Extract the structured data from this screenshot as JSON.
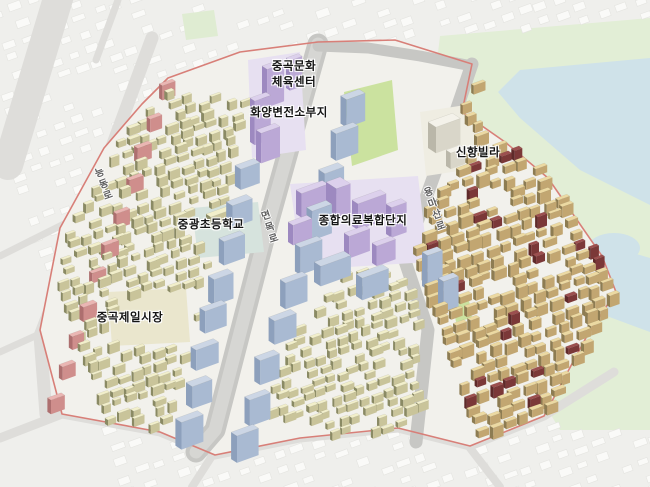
{
  "map": {
    "canvas": {
      "width": 650,
      "height": 487
    },
    "labels": [
      {
        "id": "culture-sports-center",
        "text": "중곡문화\n체육센터",
        "x": 294,
        "y": 74,
        "kind": "place"
      },
      {
        "id": "substation-site",
        "text": "화양변전소부지",
        "x": 289,
        "y": 113,
        "kind": "place"
      },
      {
        "id": "elementary-school",
        "text": "중광초등학교",
        "x": 211,
        "y": 225,
        "kind": "place"
      },
      {
        "id": "medical-complex",
        "text": "종합의료복합단지",
        "x": 363,
        "y": 221,
        "kind": "place"
      },
      {
        "id": "jeil-market",
        "text": "중곡제일시장",
        "x": 130,
        "y": 318,
        "kind": "place"
      },
      {
        "id": "shinhyang-villa",
        "text": "신향빌라",
        "x": 478,
        "y": 153,
        "kind": "place"
      },
      {
        "id": "road-neungdong-ro",
        "text": "능동로",
        "x": 102,
        "y": 185,
        "kind": "road",
        "rotate": -20
      },
      {
        "id": "road-myeonmok-ro",
        "text": "면목로",
        "x": 268,
        "y": 228,
        "kind": "road",
        "rotate": -18
      },
      {
        "id": "road-yongmasan-ro",
        "text": "용마산로",
        "x": 433,
        "y": 210,
        "kind": "road",
        "rotate": -20
      }
    ],
    "colors": {
      "bg": "#efefec",
      "context_building": "#fafaf8",
      "context_building_edge": "#e4e4e0",
      "context_road": "#deddda",
      "site_ground": "#f2f1ec",
      "road": "#c7c7c4",
      "road_inner": "#d6d6d3",
      "boundary": "#d87f78",
      "water": "#cfe2e9",
      "green_base": "#e2eed6",
      "park": "#cbe29f",
      "park_faint": "#dfecd2",
      "field": "#d6e3dd",
      "plaza": "#eae6cd",
      "plinth": "#e7e0f1",
      "plinth_ivory": "#efede2",
      "palettes": {
        "cream": [
          "#f2efcb",
          "#c9c49a",
          "#8a8a64"
        ],
        "tan": [
          "#ecd9a2",
          "#c4a store",
          "#8d7c52"
        ],
        "tan_fix": [
          "#ecd9a2",
          "#c2a671",
          "#8d7c52"
        ],
        "maroon": [
          "#9c4f4f",
          "#7b3838",
          "#5f2a2a"
        ],
        "pink": [
          "#eab6b3",
          "#cf8e8c",
          "#ad6f6f"
        ],
        "blue": [
          "#ccd6e5",
          "#a9bad2",
          "#8da0bc"
        ],
        "purple": [
          "#dcd0ec",
          "#bba8d6",
          "#9d89c0"
        ],
        "ivory": [
          "#f4f2ea",
          "#d9d6c9",
          "#bab7a9"
        ]
      }
    },
    "boundary": [
      [
        168,
        78
      ],
      [
        240,
        52
      ],
      [
        318,
        42
      ],
      [
        395,
        40
      ],
      [
        472,
        64
      ],
      [
        462,
        112
      ],
      [
        505,
        142
      ],
      [
        548,
        178
      ],
      [
        602,
        256
      ],
      [
        616,
        292
      ],
      [
        588,
        334
      ],
      [
        544,
        416
      ],
      [
        470,
        446
      ],
      [
        398,
        428
      ],
      [
        300,
        438
      ],
      [
        215,
        455
      ],
      [
        160,
        432
      ],
      [
        62,
        414
      ],
      [
        40,
        330
      ],
      [
        60,
        228
      ],
      [
        104,
        148
      ],
      [
        142,
        104
      ]
    ],
    "areas": [
      {
        "name": "hillside-green",
        "fill": "green_base",
        "pts": [
          [
            440,
            36
          ],
          [
            650,
            18
          ],
          [
            650,
            430
          ],
          [
            560,
            430
          ],
          [
            500,
            330
          ],
          [
            430,
            120
          ]
        ]
      },
      {
        "name": "stream-north",
        "fill": "water",
        "pts": [
          [
            498,
            92
          ],
          [
            520,
            70
          ],
          [
            650,
            58
          ],
          [
            650,
            205
          ],
          [
            580,
            170
          ],
          [
            520,
            118
          ]
        ]
      },
      {
        "name": "stream-east",
        "fill": "water",
        "pts": [
          [
            572,
            235
          ],
          [
            650,
            258
          ],
          [
            650,
            332
          ],
          [
            596,
            312
          ],
          [
            572,
            268
          ]
        ]
      },
      {
        "name": "pond",
        "fill": "water",
        "ellipse": [
          614,
          248,
          26,
          15
        ]
      }
    ],
    "context_roads": [
      {
        "pts": [
          [
            60,
            -8
          ],
          [
            8,
            165
          ]
        ],
        "w": 30
      },
      {
        "pts": [
          [
            152,
            38
          ],
          [
            96,
            190
          ],
          [
            40,
            336
          ],
          [
            46,
            414
          ]
        ],
        "w": 13
      },
      {
        "pts": [
          [
            0,
            438
          ],
          [
            62,
            414
          ],
          [
            160,
            432
          ],
          [
            215,
            455
          ],
          [
            300,
            438
          ],
          [
            398,
            428
          ],
          [
            470,
            446
          ],
          [
            544,
            416
          ],
          [
            614,
            372
          ]
        ],
        "w": 9
      },
      {
        "pts": [
          [
            212,
            456
          ],
          [
            192,
            487
          ]
        ],
        "w": 8
      },
      {
        "pts": [
          [
            0,
            256
          ],
          [
            96,
            208
          ]
        ],
        "w": 7
      },
      {
        "pts": [
          [
            0,
            352
          ],
          [
            44,
            332
          ]
        ],
        "w": 7
      },
      {
        "pts": [
          [
            118,
            0
          ],
          [
            96,
            60
          ]
        ],
        "w": 7
      },
      {
        "pts": [
          [
            470,
            448
          ],
          [
            500,
            487
          ]
        ],
        "w": 8
      }
    ],
    "roads": [
      {
        "name": "myeonmok-ro",
        "pts": [
          [
            318,
            44
          ],
          [
            268,
            224
          ],
          [
            215,
            430
          ],
          [
            196,
            452
          ]
        ],
        "w": 21,
        "inner": true
      },
      {
        "name": "top-boundary-road",
        "pts": [
          [
            318,
            46
          ],
          [
            368,
            48
          ],
          [
            420,
            56
          ],
          [
            472,
            66
          ]
        ],
        "w": 11
      },
      {
        "name": "yongmasan-ro",
        "pts": [
          [
            472,
            64
          ],
          [
            436,
            170
          ],
          [
            404,
            258
          ],
          [
            428,
            330
          ],
          [
            416,
            442
          ]
        ],
        "w": 13
      }
    ],
    "grounds": [
      {
        "name": "park-strip",
        "fill": "park",
        "pts": [
          [
            344,
            92
          ],
          [
            392,
            80
          ],
          [
            398,
            150
          ],
          [
            352,
            166
          ]
        ]
      },
      {
        "name": "park-small",
        "fill": "park",
        "pts": [
          [
            452,
            300
          ],
          [
            468,
            294
          ],
          [
            472,
            318
          ],
          [
            456,
            322
          ]
        ]
      },
      {
        "name": "context-park",
        "fill": "park_faint",
        "pts": [
          [
            182,
            14
          ],
          [
            214,
            10
          ],
          [
            218,
            36
          ],
          [
            186,
            40
          ]
        ]
      },
      {
        "name": "school-field",
        "fill": "field",
        "pts": [
          [
            192,
            208
          ],
          [
            258,
            202
          ],
          [
            264,
            252
          ],
          [
            198,
            258
          ]
        ]
      },
      {
        "name": "market-ground",
        "fill": "plaza",
        "pts": [
          [
            108,
            292
          ],
          [
            186,
            288
          ],
          [
            190,
            342
          ],
          [
            112,
            346
          ]
        ]
      },
      {
        "name": "medical-ground",
        "fill": "plinth",
        "pts": [
          [
            290,
            184
          ],
          [
            418,
            176
          ],
          [
            428,
            262
          ],
          [
            302,
            270
          ]
        ]
      },
      {
        "name": "culture-ground",
        "fill": "plinth",
        "pts": [
          [
            248,
            60
          ],
          [
            300,
            52
          ],
          [
            306,
            150
          ],
          [
            252,
            158
          ]
        ]
      },
      {
        "name": "villa-ground",
        "fill": "plinth_ivory",
        "pts": [
          [
            420,
            112
          ],
          [
            472,
            104
          ],
          [
            478,
            168
          ],
          [
            426,
            176
          ]
        ]
      }
    ],
    "districts": [
      {
        "type": "grid",
        "name": "west-residential-fabric",
        "palette": "cream",
        "seed": 7,
        "cell": 13,
        "row": 11,
        "size": [
          7,
          12
        ],
        "depth": [
          5,
          8
        ],
        "height": [
          5,
          10
        ],
        "skip": 0.15,
        "poly": [
          [
            170,
            84
          ],
          [
            244,
            100
          ],
          [
            230,
            178
          ],
          [
            206,
            262
          ],
          [
            188,
            344
          ],
          [
            166,
            428
          ],
          [
            64,
            412
          ],
          [
            44,
            330
          ],
          [
            62,
            232
          ],
          [
            104,
            152
          ],
          [
            142,
            106
          ]
        ],
        "holes": [
          [
            [
              192,
              208
            ],
            [
              258,
              202
            ],
            [
              264,
              252
            ],
            [
              198,
              258
            ]
          ],
          [
            [
              108,
              292
            ],
            [
              186,
              288
            ],
            [
              190,
              342
            ],
            [
              112,
              346
            ]
          ]
        ]
      },
      {
        "type": "grid",
        "name": "southeast-fabric",
        "palette": "cream",
        "seed": 11,
        "cell": 13,
        "row": 11,
        "size": [
          7,
          12
        ],
        "depth": [
          5,
          8
        ],
        "height": [
          5,
          9
        ],
        "skip": 0.15,
        "poly": [
          [
            336,
            268
          ],
          [
            402,
            272
          ],
          [
            416,
            334
          ],
          [
            418,
            424
          ],
          [
            330,
            438
          ],
          [
            260,
            412
          ],
          [
            292,
            322
          ]
        ]
      },
      {
        "type": "grid",
        "name": "east-hillside-fabric",
        "palette": "tan_fix",
        "seed": 23,
        "cell": 14,
        "row": 12,
        "size": [
          8,
          13
        ],
        "depth": [
          6,
          9
        ],
        "height": [
          6,
          12
        ],
        "skip": 0.12,
        "accent": "maroon",
        "accent_rate": 0.13,
        "poly": [
          [
            432,
            64
          ],
          [
            474,
            74
          ],
          [
            466,
            110
          ],
          [
            505,
            142
          ],
          [
            548,
            180
          ],
          [
            602,
            258
          ],
          [
            614,
            292
          ],
          [
            588,
            332
          ],
          [
            544,
            414
          ],
          [
            470,
            440
          ],
          [
            434,
            426
          ],
          [
            416,
            356
          ],
          [
            404,
            292
          ],
          [
            410,
            250
          ],
          [
            422,
            198
          ],
          [
            452,
            174
          ],
          [
            472,
            132
          ]
        ]
      },
      {
        "type": "strip",
        "name": "boundary-pink-row",
        "palette": "pink",
        "seed": 3,
        "from": [
          158,
          86
        ],
        "to": [
          46,
          396
        ],
        "count": 11,
        "size": [
          12,
          16
        ],
        "depth": [
          8,
          11
        ],
        "height": [
          10,
          16
        ]
      },
      {
        "type": "strip",
        "name": "apartments-west-of-road",
        "palette": "blue",
        "seed": 5,
        "from": [
          234,
          164
        ],
        "to": [
          176,
          420
        ],
        "count": 8,
        "size": [
          19,
          24
        ],
        "depth": [
          13,
          16
        ],
        "height": [
          20,
          28
        ]
      },
      {
        "type": "strip",
        "name": "apartments-east-of-road",
        "palette": "blue",
        "seed": 9,
        "from": [
          342,
          94
        ],
        "to": [
          232,
          432
        ],
        "count": 10,
        "size": [
          19,
          24
        ],
        "depth": [
          13,
          16
        ],
        "height": [
          22,
          30
        ]
      },
      {
        "type": "list",
        "name": "culture-sports-center-buildings",
        "palette": "purple",
        "cubes": [
          [
            262,
            66,
            18,
            13,
            38
          ],
          [
            250,
            98,
            17,
            12,
            44
          ],
          [
            256,
            130,
            20,
            13,
            30
          ],
          [
            286,
            58,
            13,
            10,
            30
          ]
        ]
      },
      {
        "type": "list",
        "name": "medical-complex-buildings",
        "palette": "purple",
        "cubes": [
          [
            296,
            190,
            28,
            14,
            24
          ],
          [
            288,
            222,
            20,
            13,
            20
          ],
          [
            326,
            182,
            15,
            26,
            30
          ],
          [
            352,
            200,
            30,
            15,
            26
          ],
          [
            344,
            233,
            22,
            13,
            22
          ],
          [
            386,
            204,
            16,
            14,
            30
          ],
          [
            372,
            243,
            20,
            12,
            20
          ]
        ]
      },
      {
        "type": "list",
        "name": "apartments-south-of-medical",
        "palette": "blue",
        "cubes": [
          [
            314,
            262,
            32,
            17,
            20
          ],
          [
            356,
            274,
            28,
            16,
            22
          ],
          [
            422,
            252,
            16,
            14,
            34
          ],
          [
            438,
            278,
            16,
            14,
            30
          ]
        ]
      },
      {
        "type": "list",
        "name": "shinhyang-villa-buildings",
        "palette": "ivory",
        "cubes": [
          [
            428,
            122,
            26,
            20,
            26
          ],
          [
            446,
            150,
            15,
            12,
            16
          ]
        ]
      },
      {
        "type": "list",
        "name": "school-building",
        "palette": "cream",
        "cubes": [
          [
            206,
            214,
            22,
            12,
            10
          ]
        ]
      }
    ]
  }
}
